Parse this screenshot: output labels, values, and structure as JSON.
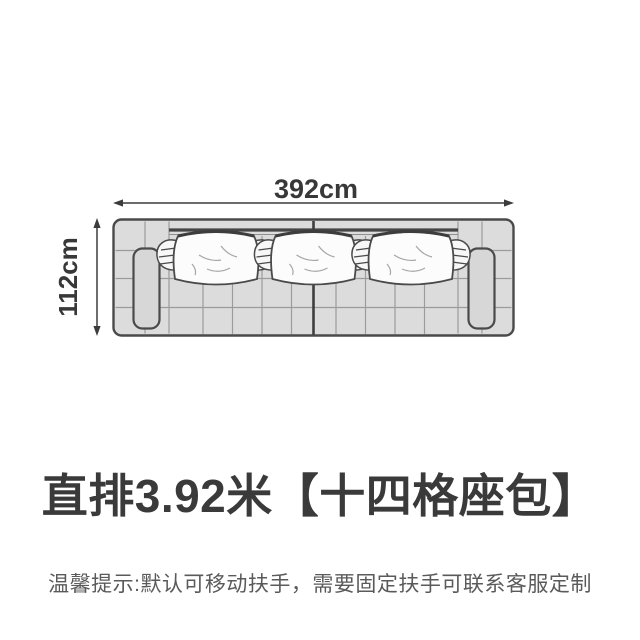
{
  "diagram": {
    "width_label": "392cm",
    "depth_label": "112cm",
    "description": "top-view line drawing of straight sofa with two armrests, three back pillows, tufted seat grid, center seam",
    "pillow_count": 3
  },
  "title": "直排3.92米【十四格座包】",
  "note": "温馨提示:默认可移动扶手，需要固定扶手可联系客服定制",
  "colors": {
    "background": "#ffffff",
    "ink": "#3a3a3a",
    "sofa_fill": "#dcdcdc",
    "sofa_outline": "#4a4a4a",
    "grid_line": "#9b9b9b",
    "pillow_fill": "#fcfcfc",
    "note_text": "#5a5a5a"
  }
}
